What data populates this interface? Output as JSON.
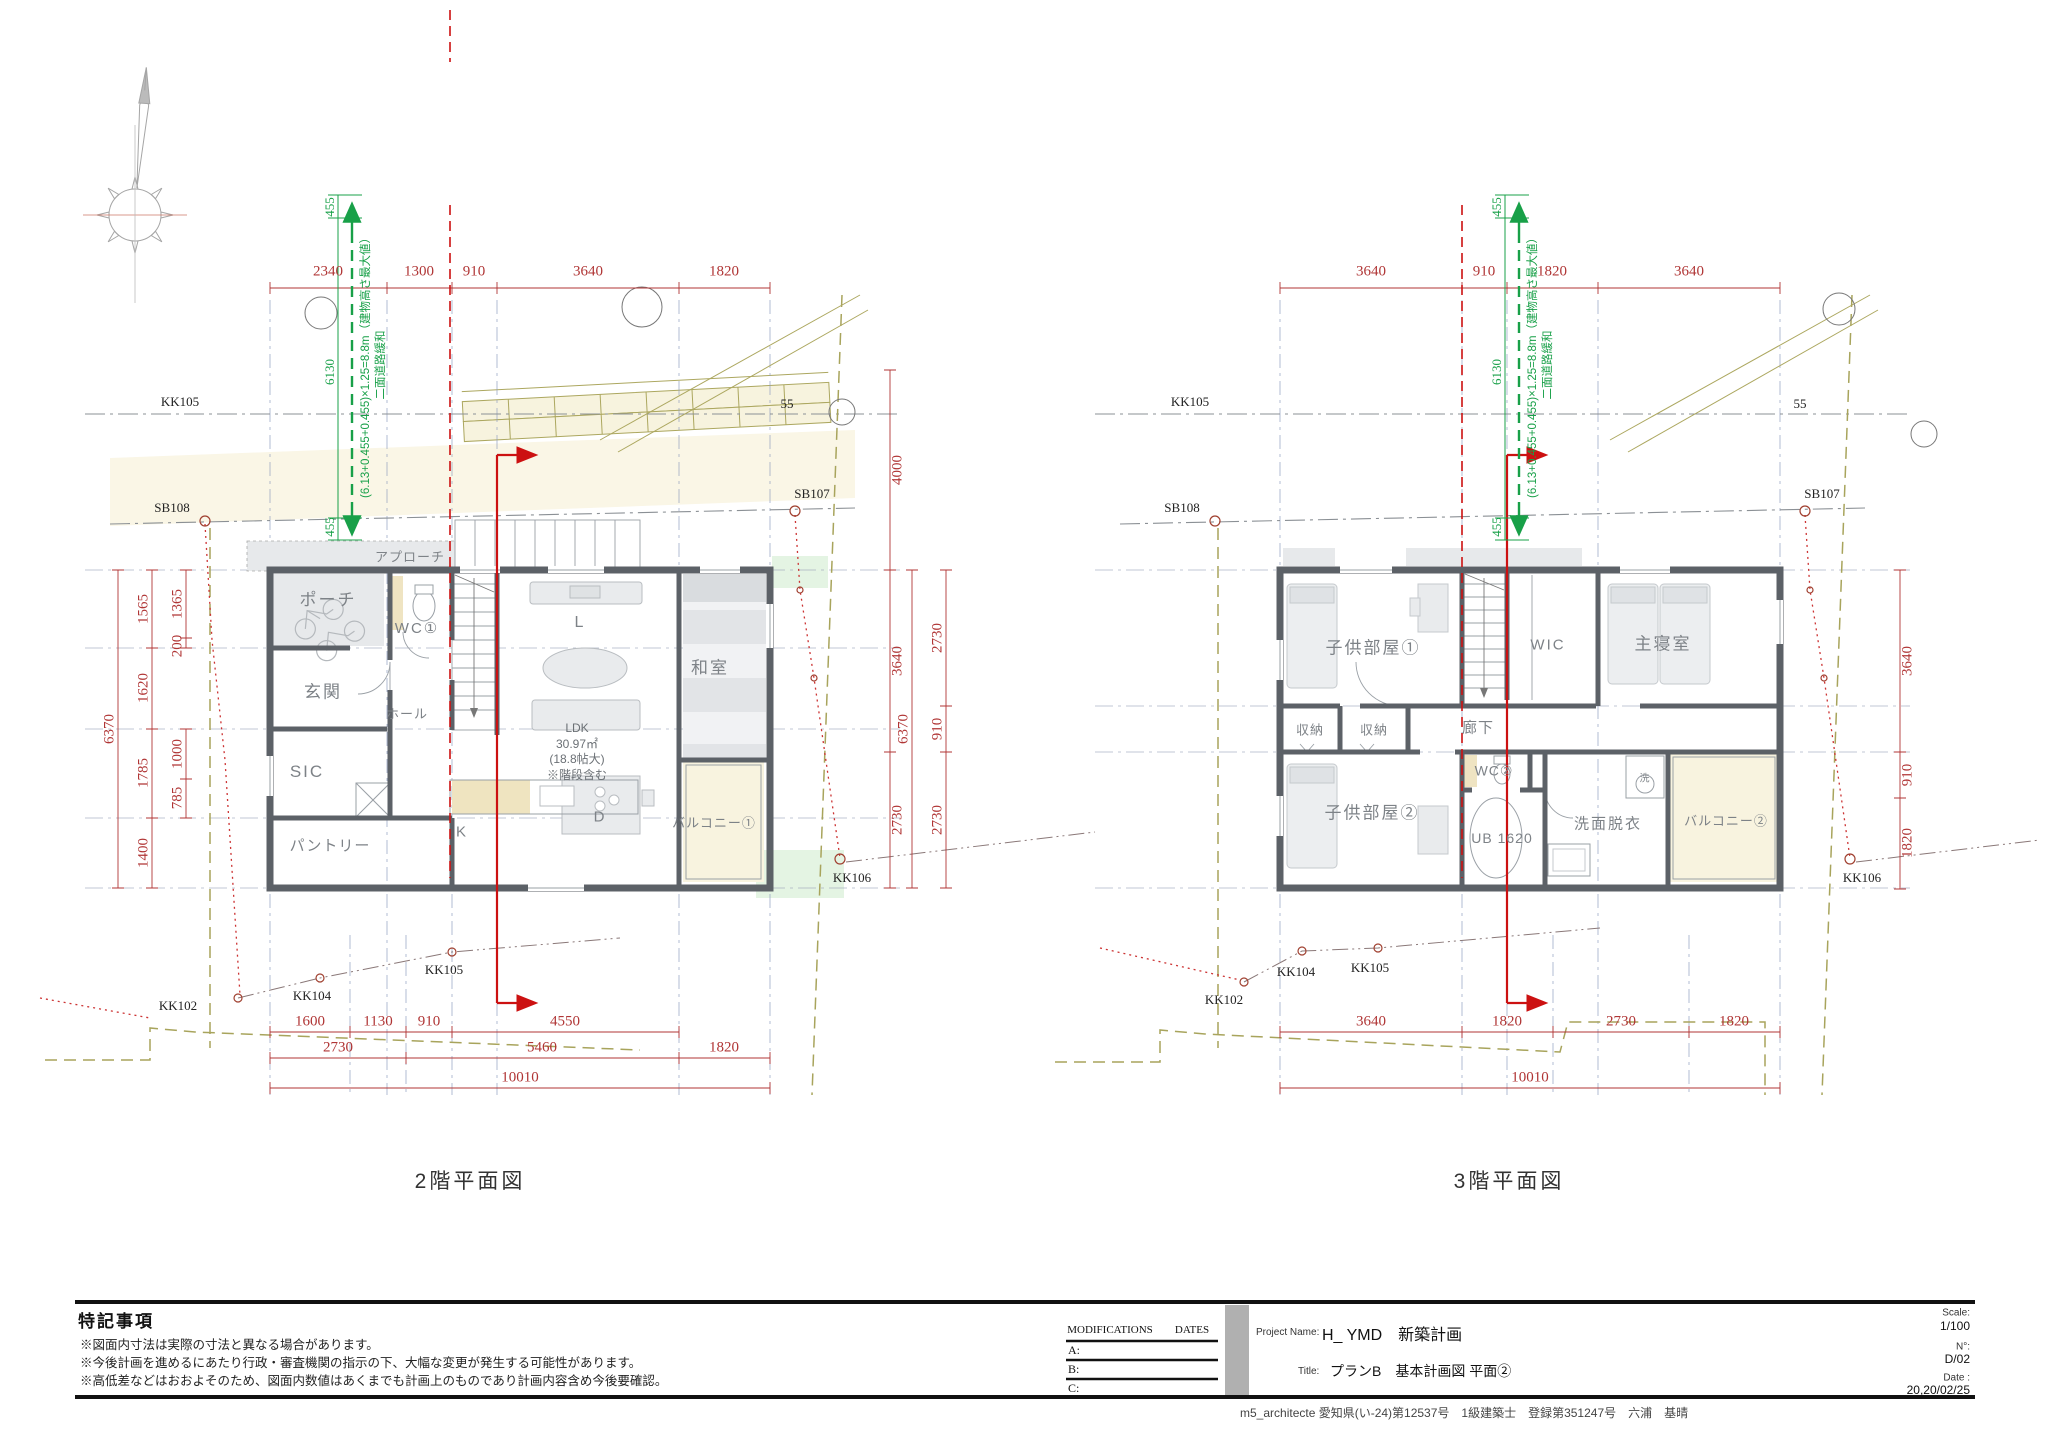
{
  "captions": {
    "plan_left": "2階平面図",
    "plan_right": "3階平面図"
  },
  "green_note": {
    "top455": "455",
    "h6130": "6130",
    "bottom455": "455",
    "formula": "(6.13+0.455+0.455)×1.25=8.8m（建物高さ最大値）",
    "relax": "二面道路緩和"
  },
  "plan2f": {
    "rooms": {
      "approach": "アプローチ",
      "porch": "ポーチ",
      "wc": "WC①",
      "genkan": "玄関",
      "hall": "ホール",
      "sic": "SIC",
      "pantry": "パントリー",
      "k": "K",
      "d": "D",
      "l": "L",
      "washitsu": "和室",
      "balcony": "バルコニー①"
    },
    "ldk": [
      "LDK",
      "30.97㎡",
      "(18.8帖大)",
      "※階段含む"
    ],
    "dims_top": [
      "2340",
      "1300",
      "910",
      "3640",
      "1820"
    ],
    "dims_left_total": "6370",
    "dims_left_main": [
      "1565",
      "1620",
      "1785",
      "1400"
    ],
    "dims_left_sub": [
      "1365",
      "200",
      "1000",
      "785"
    ],
    "dims_right": [
      "4000",
      "3640",
      "2730"
    ],
    "dims_bottom_row1": [
      "1600",
      "1130",
      "910",
      "4550"
    ],
    "dims_bottom_row2": [
      "2730",
      "5460",
      "1820"
    ],
    "dims_bottom_total": "10010",
    "markers": {
      "kk105_top": "KK105",
      "sb108": "SB108",
      "sb107": "SB107",
      "kk106": "KK106",
      "kk105_bottom": "KK105",
      "kk104": "KK104",
      "kk102": "KK102",
      "road55": "55"
    }
  },
  "plan3f": {
    "rooms": {
      "kids1": "子供部屋①",
      "wic": "WIC",
      "master": "主寝室",
      "storage1": "収納",
      "storage2": "収納",
      "corridor": "廊下",
      "kids2": "子供部屋②",
      "wc": "WC②",
      "ub": "UB 1620",
      "senmen": "洗面脱衣",
      "washer": "洗",
      "balcony": "バルコニー②"
    },
    "dims_top": [
      "3640",
      "910",
      "1820",
      "3640"
    ],
    "dims_left_total": "6370",
    "dims_left_main": [
      "2730",
      "910",
      "2730"
    ],
    "dims_right": [
      "3640",
      "910",
      "1820"
    ],
    "dims_bottom_row1": [
      "3640",
      "1820",
      "2730",
      "1820"
    ],
    "dims_bottom_total": "10010",
    "markers": {
      "kk105_top": "KK105",
      "sb108": "SB108",
      "sb107": "SB107",
      "kk106": "KK106",
      "kk105_bottom": "KK105",
      "kk104": "KK104",
      "kk102": "KK102",
      "road55": "55"
    }
  },
  "notes": {
    "title": "特記事項",
    "line1": "※図面内寸法は実際の寸法と異なる場合があります。",
    "line2": "※今後計画を進めるにあたり行政・審査機関の指示の下、大幅な変更が発生する可能性があります。",
    "line3": "※高低差などはおおよそのため、図面内数値はあくまでも計画上のものであり計画内容含め今後要確認。"
  },
  "titleblock": {
    "mods_header": "MODIFICATIONS",
    "dates_header": "DATES",
    "row_a": "A:",
    "row_b": "B:",
    "row_c": "C:",
    "project_label": "Project Name:",
    "project_name": "H_ YMD　新築計画",
    "title_label": "Title:",
    "title_value": "プランB　基本計画図 平面②",
    "scale_label": "Scale:",
    "scale_value": "1/100",
    "no_label": "N°:",
    "no_value": "D/02",
    "date_label": "Date :",
    "date_value": "20,20/02/25"
  },
  "footer": "m5_architecte 愛知県(い-24)第12537号　1級建築士　登録第351247号　六浦　基晴"
}
